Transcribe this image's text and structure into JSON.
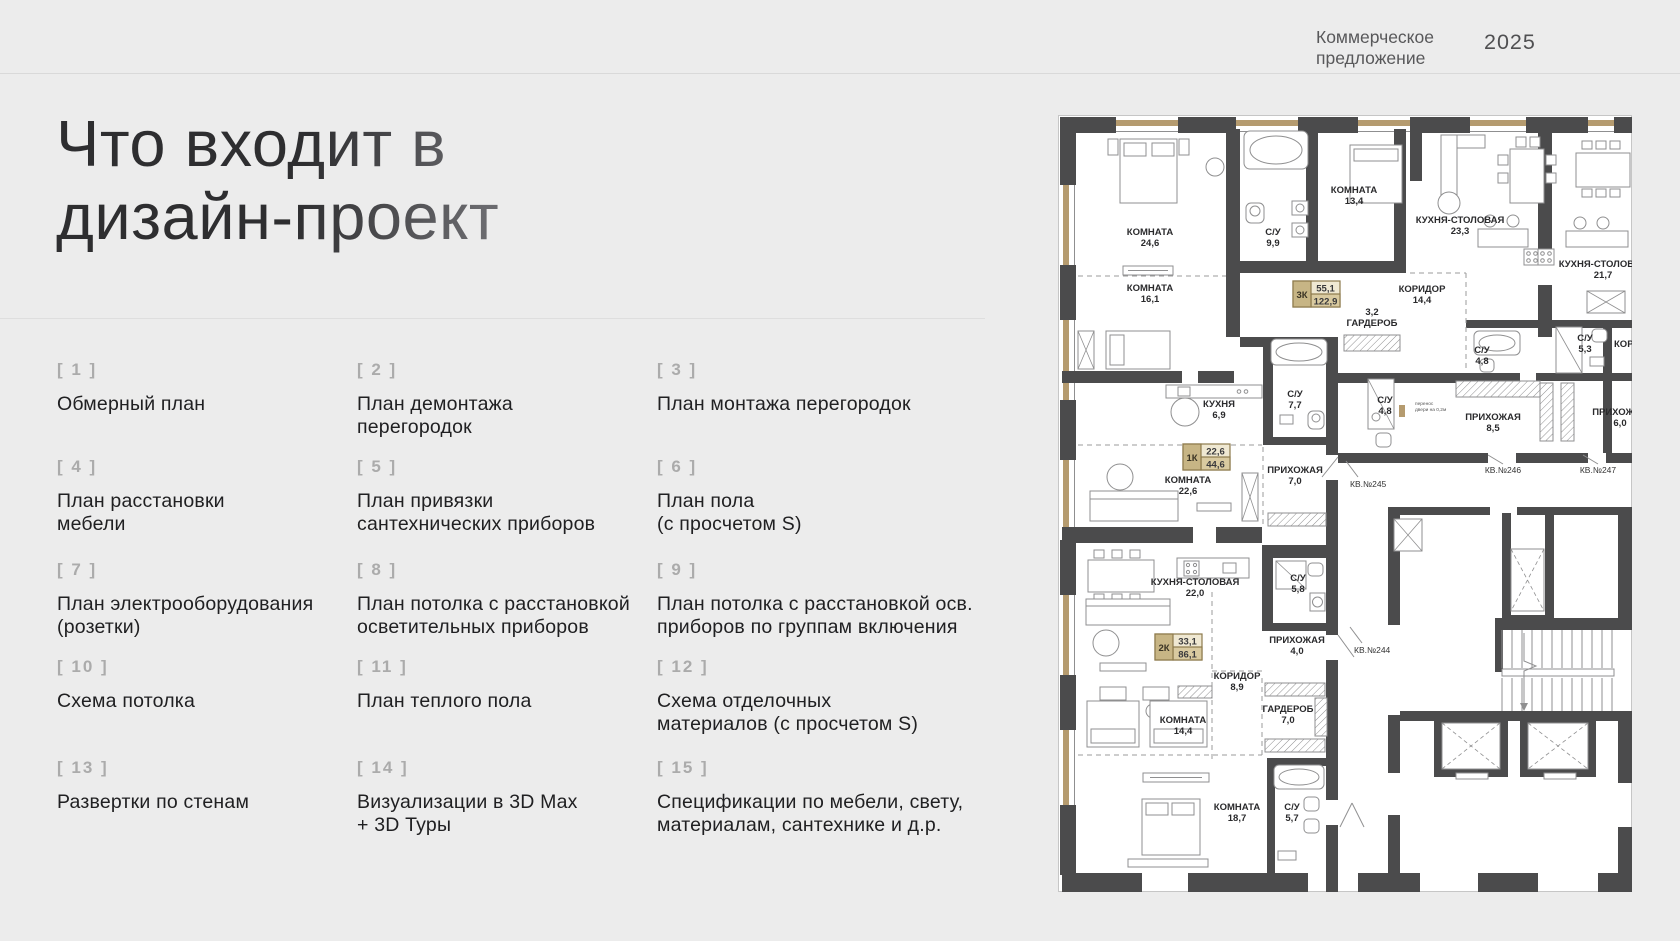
{
  "header": {
    "brand": "Коммерческое\nпредложение",
    "year": "2025"
  },
  "title": "Что входит в\nдизайн-проект",
  "list": {
    "items": [
      {
        "num": "[ 1 ]",
        "label": "Обмерный план"
      },
      {
        "num": "[ 2 ]",
        "label": "План демонтажа\nперегородок"
      },
      {
        "num": "[ 3 ]",
        "label": "План монтажа перегородок"
      },
      {
        "num": "[ 4 ]",
        "label": "План расстановки\nмебели"
      },
      {
        "num": "[ 5 ]",
        "label": "План привязки\nсантехнических приборов"
      },
      {
        "num": "[ 6 ]",
        "label": "План пола\n(с просчетом S)"
      },
      {
        "num": "[ 7 ]",
        "label": "План электрооборудования\n(розетки)"
      },
      {
        "num": "[ 8 ]",
        "label": "План потолка с расстановкой\nосветительных приборов"
      },
      {
        "num": "[ 9 ]",
        "label": "План потолка с расстановкой осв.\nприборов по группам включения"
      },
      {
        "num": "[ 10 ]",
        "label": "Схема потолка"
      },
      {
        "num": "[ 11 ]",
        "label": "План теплого пола"
      },
      {
        "num": "[ 12 ]",
        "label": "Схема отделочных\nматериалов (с просчетом S)"
      },
      {
        "num": "[ 13 ]",
        "label": "Развертки по стенам"
      },
      {
        "num": "[ 14 ]",
        "label": "Визуализации в 3D Max\n+ 3D Туры"
      },
      {
        "num": "[ 15 ]",
        "label": "Спецификации по  мебели, свету,\nматериалам, сантехнике и д.р."
      }
    ]
  },
  "plan": {
    "colors": {
      "wall": "#4b4b4c",
      "wood": "#b59b6f",
      "badge_border": "#8d7a4c",
      "badge_dark": "#c7b585",
      "badge_light": "#efe8d2",
      "badge_mid": "#d9caa0"
    },
    "rooms": [
      {
        "name": "КОМНАТА",
        "area": "24,6",
        "x": 92,
        "y": 120
      },
      {
        "name": "КОМНАТА",
        "area": "16,1",
        "x": 92,
        "y": 176
      },
      {
        "name": "С/У",
        "area": "9,9",
        "x": 215,
        "y": 120
      },
      {
        "name": "КОМНАТА",
        "area": "13,4",
        "x": 296,
        "y": 78
      },
      {
        "name": "КУХНЯ-СТОЛОВАЯ",
        "area": "23,3",
        "x": 402,
        "y": 108
      },
      {
        "name": "КУХНЯ-СТОЛОВАЯ",
        "area": "21,7",
        "x": 545,
        "y": 152
      },
      {
        "name": "КОРИДОР",
        "area": "14,4",
        "x": 364,
        "y": 177
      },
      {
        "name": "ГАРДЕРОБ",
        "area": "3,2",
        "x": 314,
        "y": 200,
        "area_first": true
      },
      {
        "name": "С/У",
        "area": "4,8",
        "x": 424,
        "y": 238
      },
      {
        "name": "С/У",
        "area": "5,3",
        "x": 527,
        "y": 226
      },
      {
        "name": "КОРИДОР",
        "area": "",
        "x": 556,
        "y": 232,
        "anchor": "start"
      },
      {
        "name": "КУХНЯ",
        "area": "6,9",
        "x": 161,
        "y": 292
      },
      {
        "name": "С/У",
        "area": "7,7",
        "x": 237,
        "y": 282
      },
      {
        "name": "С/У",
        "area": "4,8",
        "x": 327,
        "y": 288
      },
      {
        "name": "ПРИХОЖАЯ",
        "area": "8,5",
        "x": 435,
        "y": 305
      },
      {
        "name": "ПРИХОЖАЯ",
        "area": "6,0",
        "x": 562,
        "y": 300
      },
      {
        "name": "КОМНАТА",
        "area": "22,6",
        "x": 130,
        "y": 368
      },
      {
        "name": "ПРИХОЖАЯ",
        "area": "7,0",
        "x": 237,
        "y": 358
      },
      {
        "name": "КУХНЯ-СТОЛОВАЯ",
        "area": "22,0",
        "x": 137,
        "y": 470
      },
      {
        "name": "С/У",
        "area": "5,8",
        "x": 240,
        "y": 466
      },
      {
        "name": "ПРИХОЖАЯ",
        "area": "4,0",
        "x": 239,
        "y": 528
      },
      {
        "name": "КОРИДОР",
        "area": "8,9",
        "x": 179,
        "y": 564
      },
      {
        "name": "ГАРДЕРОБ",
        "area": "7,0",
        "x": 230,
        "y": 597
      },
      {
        "name": "КОМНАТА",
        "area": "14,4",
        "x": 125,
        "y": 608
      },
      {
        "name": "КОМНАТА",
        "area": "18,7",
        "x": 179,
        "y": 695
      },
      {
        "name": "С/У",
        "area": "5,7",
        "x": 234,
        "y": 695
      }
    ],
    "apartments": [
      {
        "id": "3К",
        "living": "55,1",
        "total": "122,9",
        "x": 235,
        "y": 166
      },
      {
        "id": "1К",
        "living": "22,6",
        "total": "44,6",
        "x": 125,
        "y": 329
      },
      {
        "id": "2К",
        "living": "33,1",
        "total": "86,1",
        "x": 97,
        "y": 519
      }
    ],
    "units": [
      {
        "label": "КВ.№245",
        "x": 292,
        "y": 372,
        "anchor": "start",
        "lx1": 300,
        "ly1": 362,
        "lx2": 288,
        "ly2": 346
      },
      {
        "label": "КВ.№244",
        "x": 296,
        "y": 538,
        "anchor": "start",
        "lx1": 304,
        "ly1": 528,
        "lx2": 292,
        "ly2": 512
      },
      {
        "label": "КВ.№246",
        "x": 445,
        "y": 358,
        "lx1": 445,
        "ly1": 349,
        "lx2": 430,
        "ly2": 340
      },
      {
        "label": "КВ.№247",
        "x": 540,
        "y": 358,
        "lx1": 540,
        "ly1": 349,
        "lx2": 525,
        "ly2": 340
      }
    ],
    "note": {
      "text": "перенос\nдвери на 0,2м",
      "x": 357,
      "y": 290
    }
  }
}
